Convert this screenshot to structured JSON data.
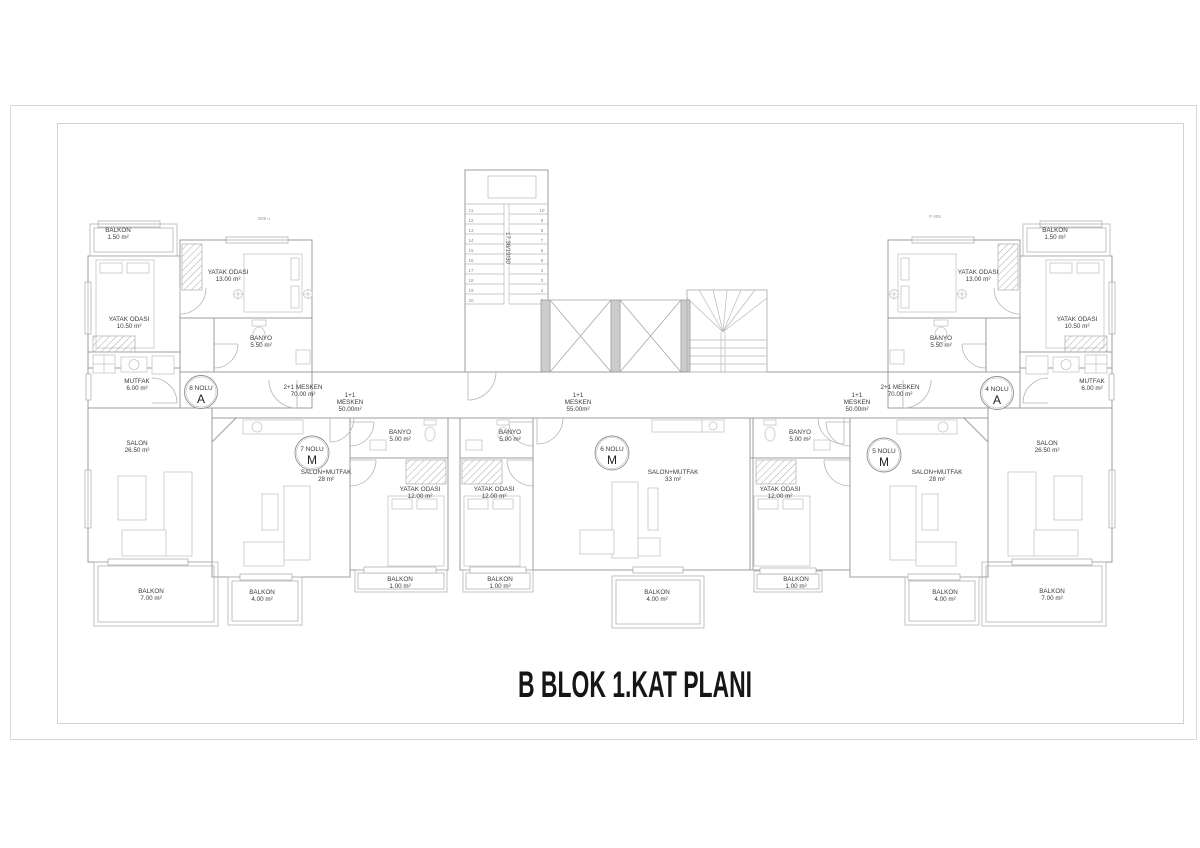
{
  "title": "B BLOK 1.KAT PLANI",
  "units": [
    {
      "label": "8 NOLU",
      "letter": "A"
    },
    {
      "label": "7 NOLU",
      "letter": "M"
    },
    {
      "label": "6 NOLU",
      "letter": "M"
    },
    {
      "label": "5 NOLU",
      "letter": "M"
    },
    {
      "label": "4 NOLU",
      "letter": "A"
    }
  ],
  "mesken": [
    {
      "l1": "2+1 MESKEN",
      "l2": "70.00 m²",
      "l3": ""
    },
    {
      "l1": "1+1",
      "l2": "MESKEN",
      "l3": "50.00m²"
    },
    {
      "l1": "1+1",
      "l2": "MESKEN",
      "l3": "55.00m²"
    },
    {
      "l1": "1+1",
      "l2": "MESKEN",
      "l3": "50.00m²"
    },
    {
      "l1": "2+1 MESKEN",
      "l2": "70.00 m²",
      "l3": ""
    }
  ],
  "rooms": [
    {
      "name": "BALKON",
      "area": "1.50 m²"
    },
    {
      "name": "YATAK ODASI",
      "area": "10.50 m²"
    },
    {
      "name": "YATAK ODASI",
      "area": "13.00 m²"
    },
    {
      "name": "BANYO",
      "area": "5.50 m²"
    },
    {
      "name": "MUTFAK",
      "area": "6.00 m²"
    },
    {
      "name": "SALON",
      "area": "26.50 m²"
    },
    {
      "name": "BALKON",
      "area": "7.00 m²"
    },
    {
      "name": "SALON+MUTFAK",
      "area": "28 m²"
    },
    {
      "name": "BANYO",
      "area": "5.00 m²"
    },
    {
      "name": "YATAK ODASI",
      "area": "12.00 m²"
    },
    {
      "name": "BALKON",
      "area": "4.00 m²"
    },
    {
      "name": "BALKON",
      "area": "1.00 m²"
    },
    {
      "name": "BANYO",
      "area": "5.00 m²"
    },
    {
      "name": "YATAK ODASI",
      "area": "12.00 m²"
    },
    {
      "name": "SALON+MUTFAK",
      "area": "33 m²"
    },
    {
      "name": "BALKON",
      "area": "1.00 m²"
    },
    {
      "name": "BALKON",
      "area": "4.00 m²"
    },
    {
      "name": "BANYO",
      "area": "5.00 m²"
    },
    {
      "name": "YATAK ODASI",
      "area": "12.00 m²"
    },
    {
      "name": "SALON+MUTFAK",
      "area": "28 m²"
    },
    {
      "name": "BALKON",
      "area": "1.00 m²"
    },
    {
      "name": "BALKON",
      "area": "4.00 m²"
    },
    {
      "name": "BALKON",
      "area": "1.50 m²"
    },
    {
      "name": "YATAK ODASI",
      "area": "13.00 m²"
    },
    {
      "name": "YATAK ODASI",
      "area": "10.50 m²"
    },
    {
      "name": "BANYO",
      "area": "5.50 m²"
    },
    {
      "name": "MUTFAK",
      "area": "6.00 m²"
    },
    {
      "name": "SALON",
      "area": "26.50 m²"
    },
    {
      "name": "BALKON",
      "area": "7.00 m²"
    }
  ],
  "stair": {
    "dim": "17.36/19/30",
    "left": [
      "11",
      "12",
      "13",
      "14",
      "15",
      "16",
      "17",
      "18",
      "19",
      "20"
    ],
    "right": [
      "10",
      "9",
      "8",
      "7",
      "6",
      "5",
      "4",
      "3",
      "2",
      "1"
    ]
  },
  "wlabels": [
    "B05 u",
    "P 605"
  ]
}
